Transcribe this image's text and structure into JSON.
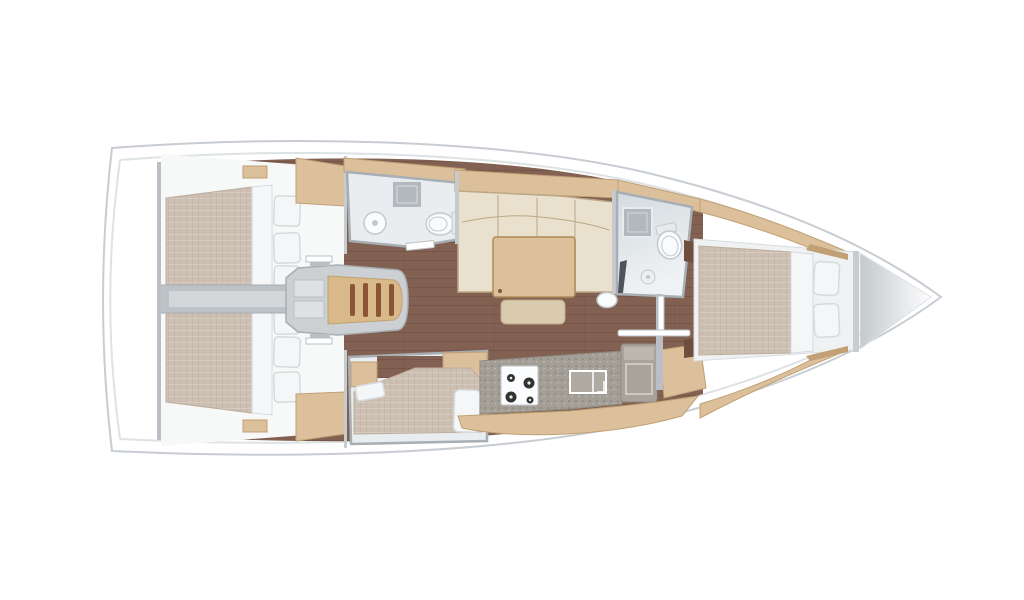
{
  "meta": {
    "title": "Sailing yacht interior layout — top-down floor plan",
    "orientation": "bow-right"
  },
  "colors": {
    "hull_stroke": "#c7cdd2",
    "hull_inner": "#dde2e5",
    "floor": "#826052",
    "floor_line": "#6a4e42",
    "wood": "#dcc09b",
    "wood_dark": "#c0a074",
    "walnut": "#6f4e3d",
    "mattress": "#cdbfb1",
    "mattress_line": "#bdae9d",
    "bedding": "#f5f6f7",
    "bedding_stroke": "#d6dadd",
    "sofa": "#e9e0cd",
    "sofa_stroke": "#bca886",
    "wall": "#a7aeb4",
    "wall_light": "#c6cbcf",
    "bath_floor": "#e9edf0",
    "fixture": "#fafbfc",
    "fixture_stroke": "#c2c8cd",
    "granite": "#b2b8bd",
    "counter": "#a49f96",
    "counter_stroke": "#8d887f",
    "stove": "#fbfcfd",
    "burner": "#333333",
    "steel": "#b9bfc4",
    "engine_band": "#bcc2c6",
    "stairs_wood": "#d9b989",
    "stairs_slat": "#8a5437",
    "locker_start": "#c2c8cc",
    "locker_end": "#fdfdfe"
  },
  "regions": {
    "aft_cabin_port": "aft double cabin (top)",
    "aft_cabin_starboard": "aft double cabin (bottom)",
    "companionway": "companionway stairs",
    "aft_head": "aft bathroom with toilet and sink",
    "saloon": "saloon with L-sofa, table and bench",
    "side_berth": "lower side berth cabin",
    "galley": "galley with stove, sink and fridge",
    "forward_head": "forward bathroom with shower and toilet",
    "forward_cabin": "forward owner cabin with island bed",
    "anchor_locker": "bow anchor locker"
  }
}
